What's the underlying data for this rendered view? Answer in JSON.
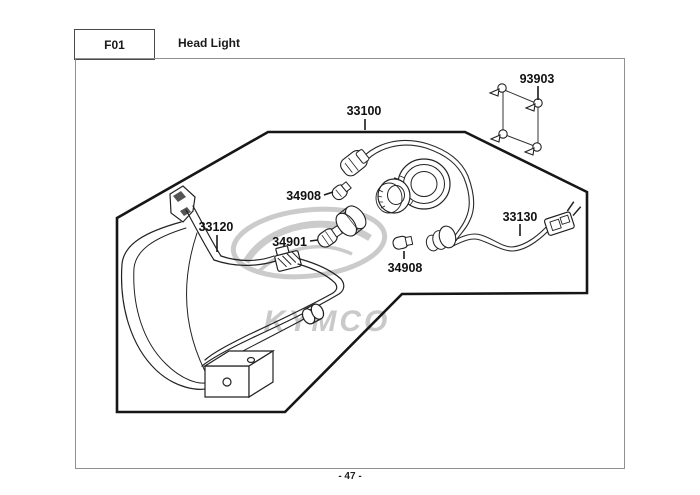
{
  "header": {
    "code": "F01",
    "title": "Head Light"
  },
  "footer": {
    "page_number": "- 47 -"
  },
  "watermark": {
    "brand": "KYMCO"
  },
  "labels": {
    "screw_set": "93903",
    "harness": "33100",
    "bulb_upper": "34908",
    "housing": "33120",
    "bulb_main": "34901",
    "bulb_lower": "34908",
    "wire_connector": "33130"
  },
  "colors": {
    "line_art": "#222222",
    "diagram_frame": "#161616",
    "page_border": "#909090",
    "watermark": "#c9c9c9",
    "label_text": "#111111"
  }
}
